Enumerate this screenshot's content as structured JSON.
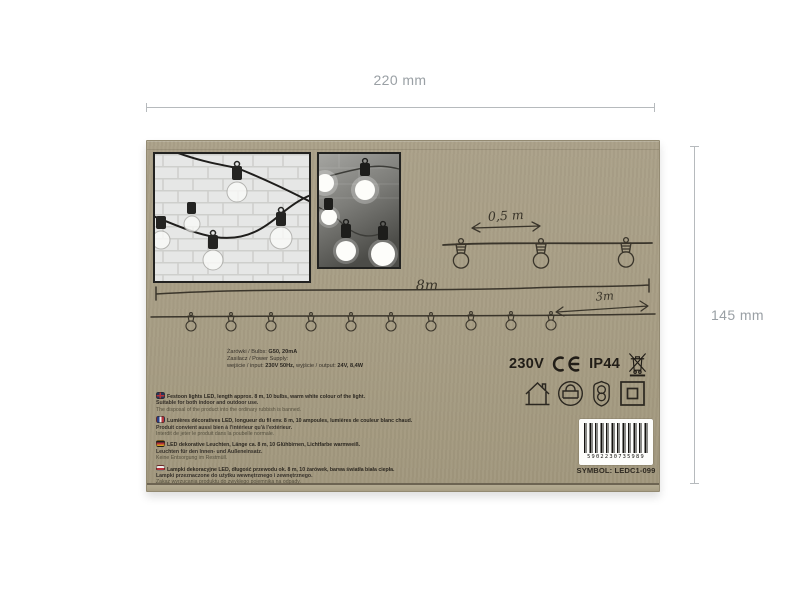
{
  "page": {
    "background": "#ffffff"
  },
  "dimensions": {
    "width_label": "220 mm",
    "height_label": "145 mm",
    "annotation_color": "#9aa0a5"
  },
  "box": {
    "cardboard_color": "#a79d84",
    "ink_color": "#3a352b",
    "photos": [
      {
        "name": "festoon-lights-on-white-brick-wall"
      },
      {
        "name": "festoon-lights-glowing-warm-white"
      }
    ],
    "diagram": {
      "bulb_spacing_label": "0,5 m",
      "total_length_label": "8m",
      "lead_length_label": "3m",
      "bulb_count": 10
    },
    "specs": {
      "bulbs_label": "Żarówki / Bulbs:",
      "bulbs_value": "G50, 20mA",
      "power_label": "Zasilacz / Power Supply:",
      "input_label": "wejście / input:",
      "input_value": "230V 50Hz,",
      "output_label": "wyjście / output:",
      "output_value": "24V, 8,4W"
    },
    "ratings": {
      "voltage": "230V",
      "ce_mark": "CE",
      "ip_rating": "IP44",
      "weee_icon": "crossed-out-wheelie-bin"
    },
    "safety_icons": [
      {
        "name": "indoor-outdoor-house-icon"
      },
      {
        "name": "transformer-icon"
      },
      {
        "name": "safety-transformer-shield-icon"
      },
      {
        "name": "class-2-double-insulation-icon"
      }
    ],
    "descriptions": [
      {
        "lang": "EN",
        "lines": [
          "Festoon lights LED, length approx. 8 m, 10 bulbs, warm white colour of the light.",
          "Suitable for both indoor and outdoor use.",
          "The disposal of the product into the ordinary rubbish is banned."
        ]
      },
      {
        "lang": "FR",
        "lines": [
          "Lumières décoratives LED, longueur du fil env. 8 m, 10 ampoules, lumières de couleur blanc chaud.",
          "Produit convient aussi bien à l'intérieur qu'à l'extérieur.",
          "Interdit de jeter le produit dans la poubelle normale."
        ]
      },
      {
        "lang": "DE",
        "lines": [
          "LED dekorative Leuchten, Länge ca. 8 m, 10 Glühbirnen, Lichtfarbe warmweiß.",
          "Leuchten für den Innen- und Außeneinsatz.",
          "Keine Entsorgung im Restmüll."
        ]
      },
      {
        "lang": "PL",
        "lines": [
          "Lampki dekoracyjne LED, długość przewodu ok. 8 m, 10 żarówek, barwa światła biała ciepła.",
          "Lampki przeznaczone do użytku wewnętrznego i zewnętrznego.",
          "Zakaz wyrzucania produktu do zwykłego pojemnika na odpady."
        ]
      }
    ],
    "barcode": {
      "number": "5902230735989",
      "symbol_label": "SYMBOL: LEDC1-099"
    }
  }
}
